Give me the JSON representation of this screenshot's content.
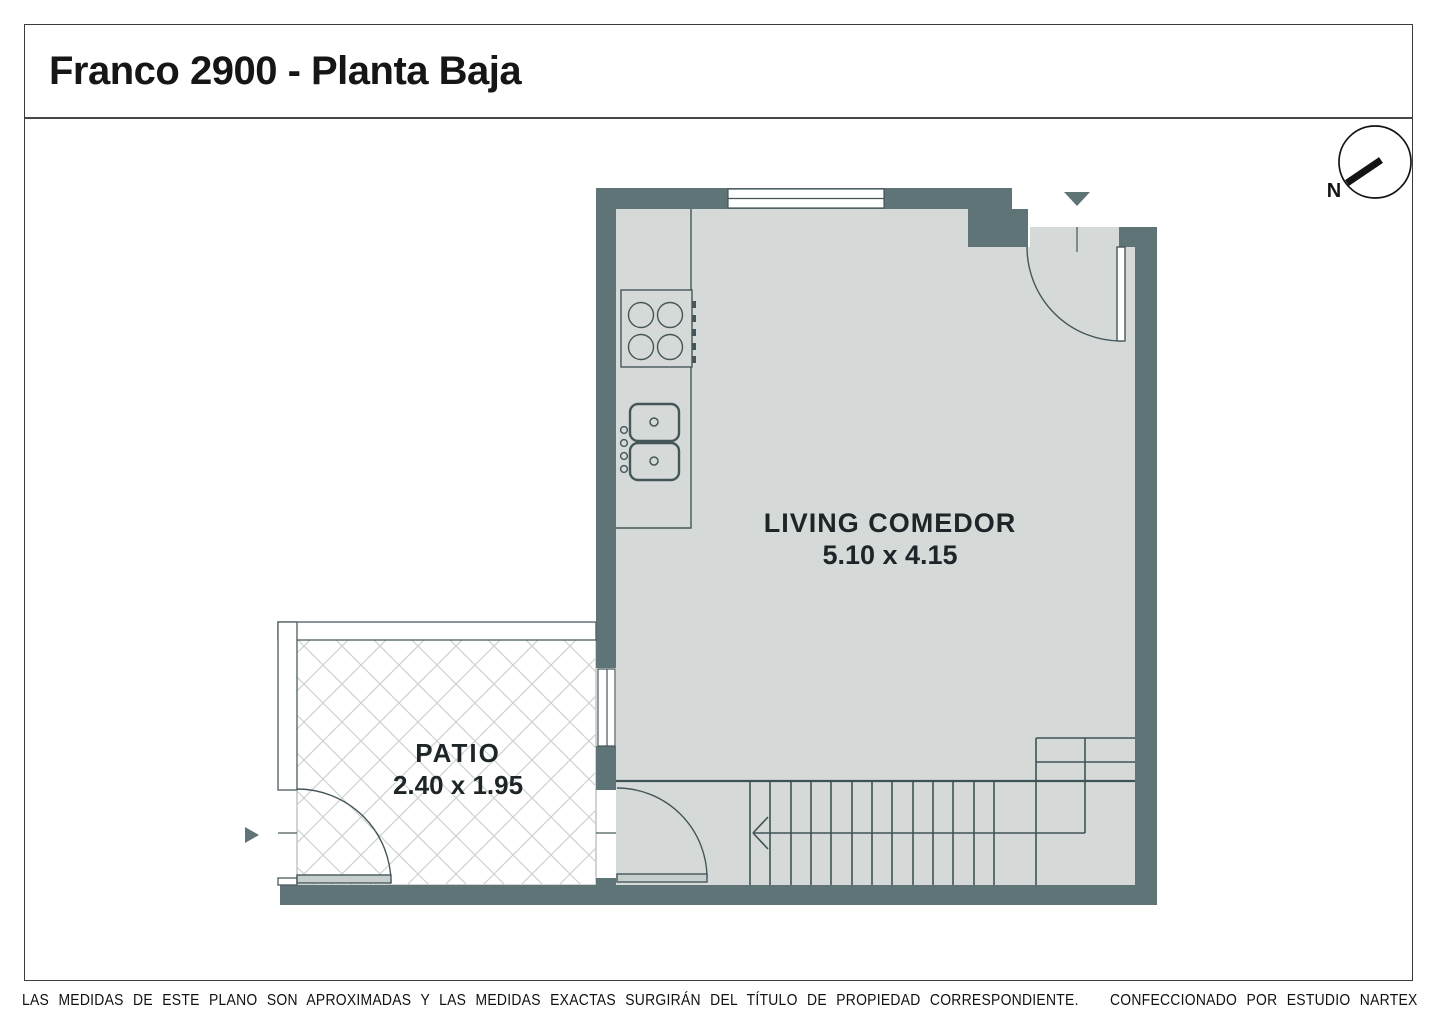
{
  "header": {
    "title": "Franco 2900 - Planta Baja"
  },
  "compass": {
    "label": "N"
  },
  "rooms": [
    {
      "name": "LIVING COMEDOR",
      "dimensions": "5.10 x 4.15"
    },
    {
      "name": "PATIO",
      "dimensions": "2.40 x 1.95"
    }
  ],
  "footer": {
    "disclaimer": "LAS MEDIDAS  DE ESTE PLANO SON APROXIMADAS Y LAS MEDIDAS EXACTAS SURGIRÁN DEL TÍTULO DE PROPIEDAD CORRESPONDIENTE.",
    "credit": "CONFECCIONADO POR ESTUDIO NARTEX"
  },
  "colors": {
    "wall": "#5e7477",
    "floor": "#d5dad8",
    "line": "#44565a",
    "hatch": "#ccd3d1",
    "border": "#3b3b3b"
  }
}
